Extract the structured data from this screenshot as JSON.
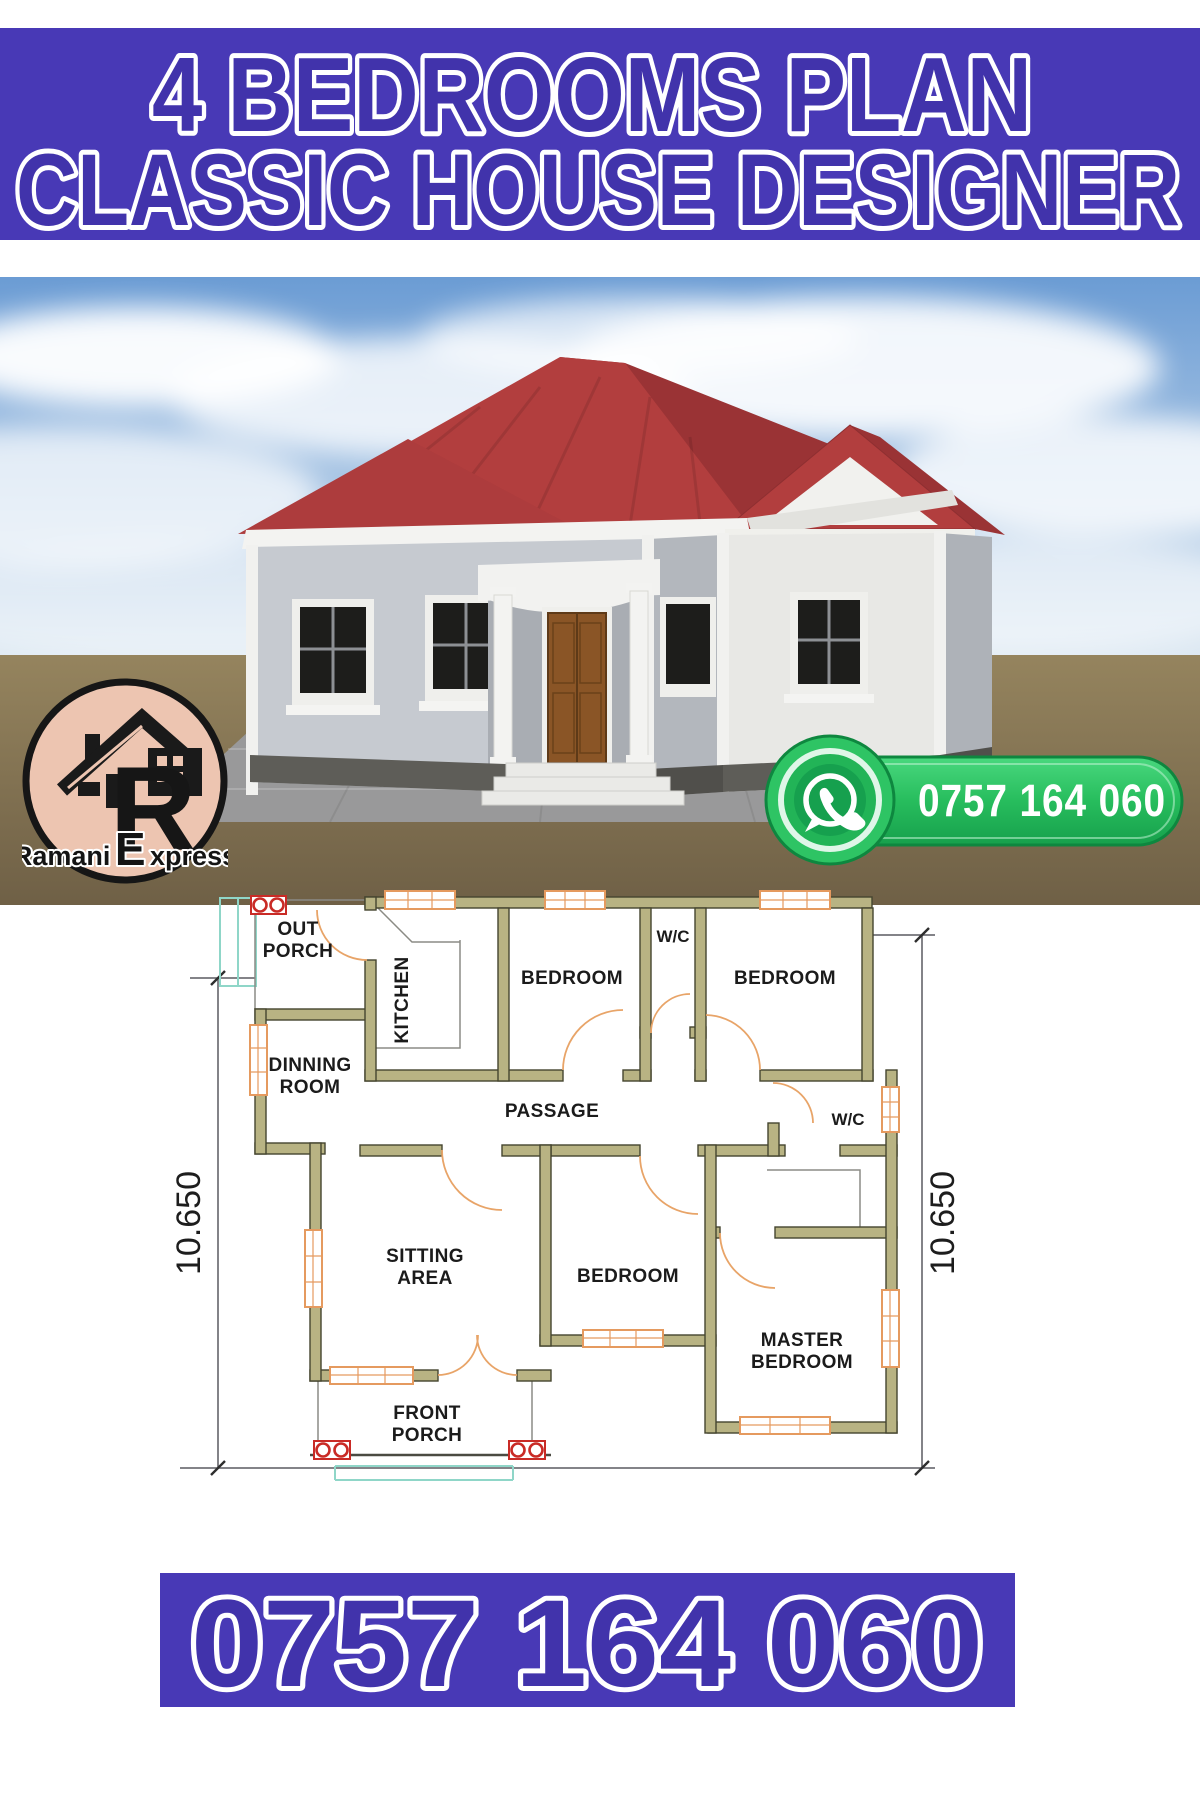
{
  "header": {
    "line1": "4 BEDROOMS PLAN",
    "line2": "CLASSIC HOUSE DESIGNER"
  },
  "logo": {
    "monogram": "R",
    "brand_start": "Ramani",
    "brand_initial": "E",
    "brand_end": "xpress"
  },
  "contact": {
    "whatsapp_number": "0757 164 060",
    "footer_number": "0757 164 060"
  },
  "floor_plan": {
    "dimensions": {
      "left": "10.650",
      "right": "10.650"
    },
    "rooms": {
      "out_porch": [
        "OUT",
        "PORCH"
      ],
      "kitchen": "KITCHEN",
      "bedroom_top_left": "BEDROOM",
      "wc_top": "W/C",
      "bedroom_top_right": "BEDROOM",
      "dinning_room": [
        "DINNING",
        "ROOM"
      ],
      "passage": "PASSAGE",
      "wc_right": "W/C",
      "sitting_area": [
        "SITTING",
        "AREA"
      ],
      "bedroom_bottom": "BEDROOM",
      "master_bedroom": [
        "MASTER",
        "BEDROOM"
      ],
      "front_porch": [
        "FRONT",
        "PORCH"
      ]
    }
  },
  "colors": {
    "banner_bg": "#4839b6",
    "banner_letters": "#4133ab",
    "roof_red": "#b23e3e",
    "wall_gray": "#c6cad0",
    "plinth_gray": "#5e5d58",
    "sky_blue": "#6b9cd4",
    "ground_brown": "#8d7c5b",
    "whatsapp_green": "#2ec464",
    "logo_peach": "#edc5b1",
    "plan_wall_olive": "#b8b383",
    "plan_window_orange": "#e59a5f",
    "plan_step_teal": "#8fd6c8",
    "plan_column_red": "#c92b26"
  }
}
